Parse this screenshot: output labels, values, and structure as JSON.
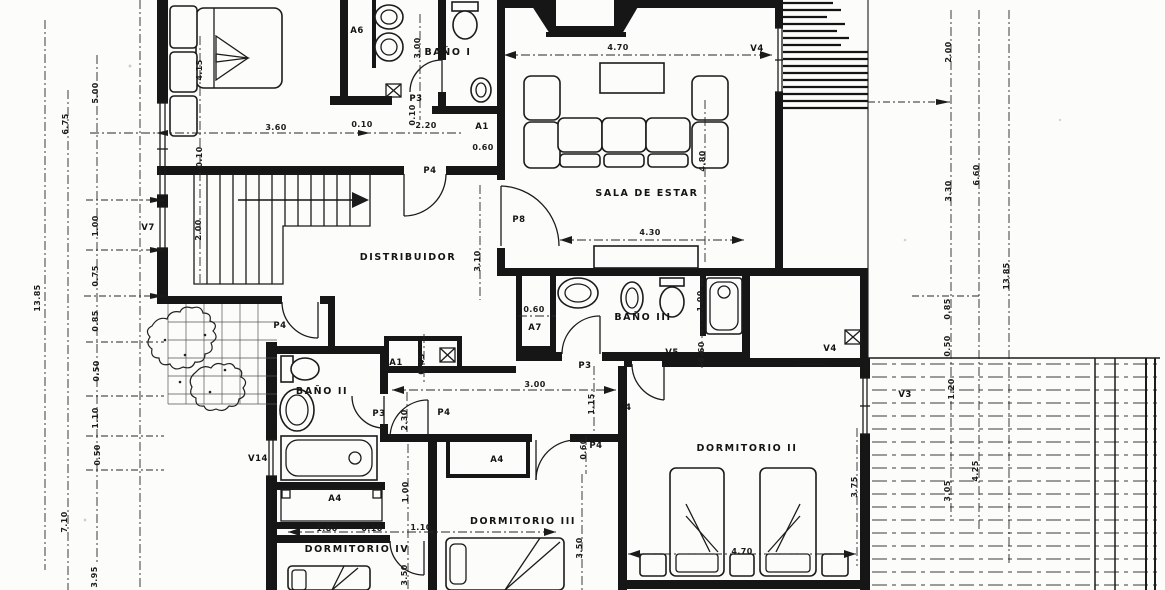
{
  "plan": {
    "room_labels": [
      {
        "text": "SALA DE ESTAR",
        "x": 647,
        "y": 196
      },
      {
        "text": "DISTRIBUIDOR",
        "x": 408,
        "y": 260
      },
      {
        "text": "BAÑO I",
        "x": 448,
        "y": 55
      },
      {
        "text": "BAÑO II",
        "x": 322,
        "y": 394
      },
      {
        "text": "BAÑO III",
        "x": 643,
        "y": 320
      },
      {
        "text": "DORMITORIO II",
        "x": 747,
        "y": 451
      },
      {
        "text": "DORMITORIO III",
        "x": 523,
        "y": 524
      },
      {
        "text": "DORMITORIO IV",
        "x": 357,
        "y": 552
      }
    ],
    "door_labels": [
      {
        "text": "A6",
        "x": 357,
        "y": 33
      },
      {
        "text": "P3",
        "x": 416,
        "y": 101
      },
      {
        "text": "A1",
        "x": 482,
        "y": 129
      },
      {
        "text": "P4",
        "x": 430,
        "y": 173
      },
      {
        "text": "P8",
        "x": 519,
        "y": 222
      },
      {
        "text": "P4",
        "x": 280,
        "y": 328
      },
      {
        "text": "A7",
        "x": 535,
        "y": 330
      },
      {
        "text": "A1",
        "x": 396,
        "y": 365
      },
      {
        "text": "P3",
        "x": 585,
        "y": 368
      },
      {
        "text": "P4",
        "x": 625,
        "y": 410
      },
      {
        "text": "P4",
        "x": 444,
        "y": 415
      },
      {
        "text": "P3",
        "x": 379,
        "y": 416
      },
      {
        "text": "P4",
        "x": 596,
        "y": 448
      },
      {
        "text": "A4",
        "x": 497,
        "y": 462
      },
      {
        "text": "A4",
        "x": 335,
        "y": 501
      }
    ],
    "window_labels": [
      {
        "text": "V4",
        "x": 757,
        "y": 51
      },
      {
        "text": "V7",
        "x": 148,
        "y": 230
      },
      {
        "text": "V5",
        "x": 672,
        "y": 355
      },
      {
        "text": "V4",
        "x": 830,
        "y": 351
      },
      {
        "text": "V3",
        "x": 905,
        "y": 397
      },
      {
        "text": "V14",
        "x": 258,
        "y": 461
      }
    ],
    "dim_labels": [
      {
        "text": "13.85",
        "x": 40,
        "y": 298,
        "rot": -90
      },
      {
        "text": "6.75",
        "x": 68,
        "y": 124,
        "rot": -90
      },
      {
        "text": "7.10",
        "x": 67,
        "y": 522,
        "rot": -90
      },
      {
        "text": "5.00",
        "x": 98,
        "y": 93,
        "rot": -90
      },
      {
        "text": "1.00",
        "x": 98,
        "y": 226,
        "rot": -90
      },
      {
        "text": "0.75",
        "x": 98,
        "y": 276,
        "rot": -90
      },
      {
        "text": "0.85",
        "x": 98,
        "y": 321,
        "rot": -90
      },
      {
        "text": "0.50",
        "x": 99,
        "y": 371,
        "rot": -90
      },
      {
        "text": "1.10",
        "x": 98,
        "y": 418,
        "rot": -90
      },
      {
        "text": "0.50",
        "x": 100,
        "y": 455,
        "rot": -90
      },
      {
        "text": "3.95",
        "x": 97,
        "y": 577,
        "rot": -90
      },
      {
        "text": "4.15",
        "x": 202,
        "y": 70,
        "rot": -90
      },
      {
        "text": "0.10",
        "x": 202,
        "y": 157,
        "rot": -90
      },
      {
        "text": "2.00",
        "x": 201,
        "y": 230,
        "rot": -90
      },
      {
        "text": "3.60",
        "x": 276,
        "y": 130
      },
      {
        "text": "0.10",
        "x": 362,
        "y": 127
      },
      {
        "text": "2.20",
        "x": 426,
        "y": 128
      },
      {
        "text": "0.60",
        "x": 483,
        "y": 150
      },
      {
        "text": "3.00",
        "x": 420,
        "y": 48,
        "rot": -90
      },
      {
        "text": "0.10",
        "x": 415,
        "y": 115,
        "rot": -90
      },
      {
        "text": "4.70",
        "x": 618,
        "y": 50
      },
      {
        "text": "4.80",
        "x": 705,
        "y": 161,
        "rot": -90
      },
      {
        "text": "4.30",
        "x": 650,
        "y": 235
      },
      {
        "text": "3.10",
        "x": 480,
        "y": 261,
        "rot": -90
      },
      {
        "text": "2.00",
        "x": 951,
        "y": 52,
        "rot": -90
      },
      {
        "text": "6.60",
        "x": 979,
        "y": 175,
        "rot": -90
      },
      {
        "text": "3.30",
        "x": 951,
        "y": 191,
        "rot": -90
      },
      {
        "text": "13.85",
        "x": 1009,
        "y": 276,
        "rot": -90
      },
      {
        "text": "0.85",
        "x": 950,
        "y": 309,
        "rot": -90
      },
      {
        "text": "0.50",
        "x": 950,
        "y": 346,
        "rot": -90
      },
      {
        "text": "1.20",
        "x": 954,
        "y": 389,
        "rot": -90
      },
      {
        "text": "4.25",
        "x": 978,
        "y": 471,
        "rot": -90
      },
      {
        "text": "3.05",
        "x": 950,
        "y": 491,
        "rot": -90
      },
      {
        "text": "0.60",
        "x": 534,
        "y": 312
      },
      {
        "text": "1.00",
        "x": 703,
        "y": 301,
        "rot": -90
      },
      {
        "text": "0.60",
        "x": 704,
        "y": 352,
        "rot": -90
      },
      {
        "text": "0.45",
        "x": 424,
        "y": 364,
        "rot": -90
      },
      {
        "text": "2.30",
        "x": 407,
        "y": 420,
        "rot": -90
      },
      {
        "text": "3.00",
        "x": 535,
        "y": 387
      },
      {
        "text": "1.15",
        "x": 594,
        "y": 404,
        "rot": -90
      },
      {
        "text": "0.60",
        "x": 586,
        "y": 449,
        "rot": -90
      },
      {
        "text": "1.00",
        "x": 408,
        "y": 492,
        "rot": -90
      },
      {
        "text": "1.80",
        "x": 327,
        "y": 531
      },
      {
        "text": "0.10",
        "x": 372,
        "y": 531
      },
      {
        "text": "1.10",
        "x": 421,
        "y": 530
      },
      {
        "text": "3.50",
        "x": 407,
        "y": 575,
        "rot": -90
      },
      {
        "text": "3.50",
        "x": 582,
        "y": 548,
        "rot": -90
      },
      {
        "text": "3.75",
        "x": 857,
        "y": 487,
        "rot": -90
      },
      {
        "text": "4.70",
        "x": 742,
        "y": 554
      }
    ]
  }
}
